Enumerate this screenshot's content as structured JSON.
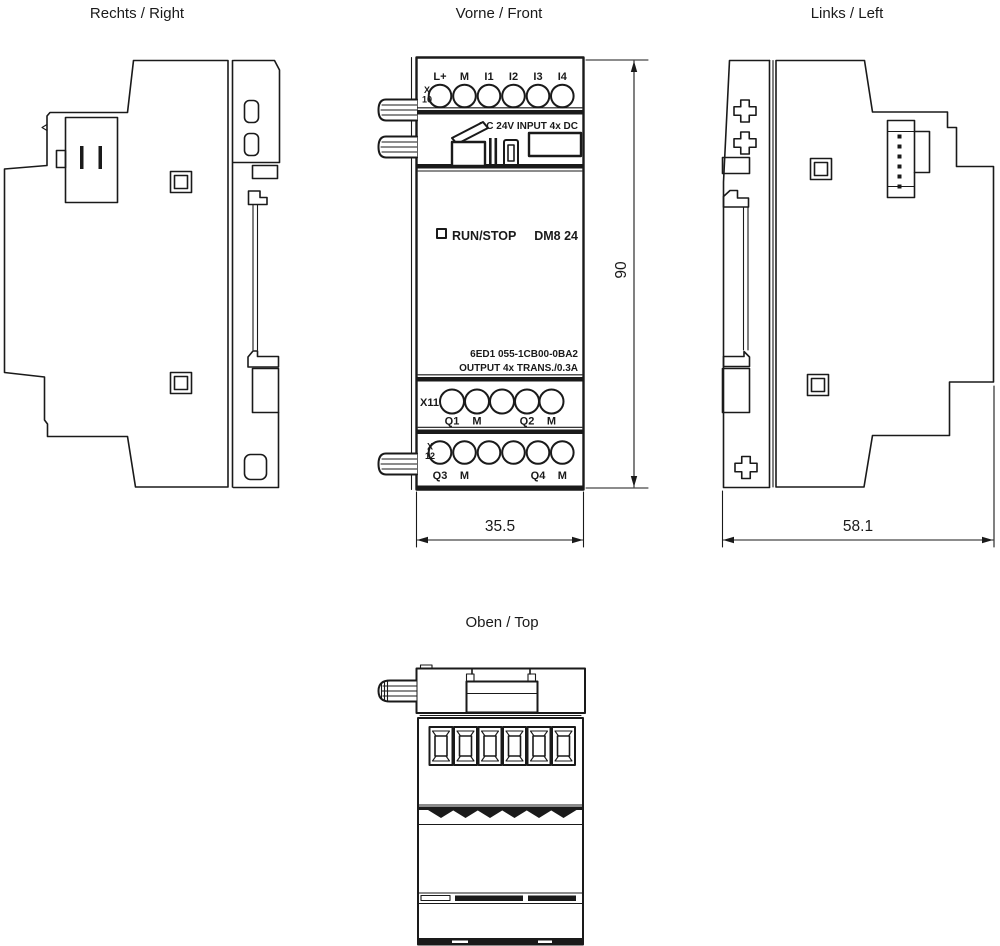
{
  "titles": {
    "right": "Rechts / Right",
    "front": "Vorne / Front",
    "left": "Links / Left",
    "top": "Oben / Top"
  },
  "front_panel": {
    "x10": {
      "line1": "X",
      "line2": "10"
    },
    "input_terminals": [
      "L+",
      "M",
      "I1",
      "I2",
      "I3",
      "I4"
    ],
    "input_caption": "DC 24V INPUT 4x DC",
    "led_label": "RUN/STOP",
    "model": "DM8 24",
    "order_number": "6ED1 055-1CB00-0BA2",
    "output_caption": "OUTPUT 4x TRANS./0.3A",
    "x11_label": "X11",
    "x11_terminals": [
      "Q1",
      "M",
      "Q2",
      "M"
    ],
    "x12": {
      "line1": "X",
      "line2": "12"
    },
    "x12_terminals": [
      "Q3",
      "M",
      "Q4",
      "M"
    ]
  },
  "dimensions": {
    "height_mm": "90",
    "width_mm": "35.5",
    "depth_mm": "58.1"
  },
  "colors": {
    "line": "#1a1a1a",
    "background": "#ffffff"
  }
}
